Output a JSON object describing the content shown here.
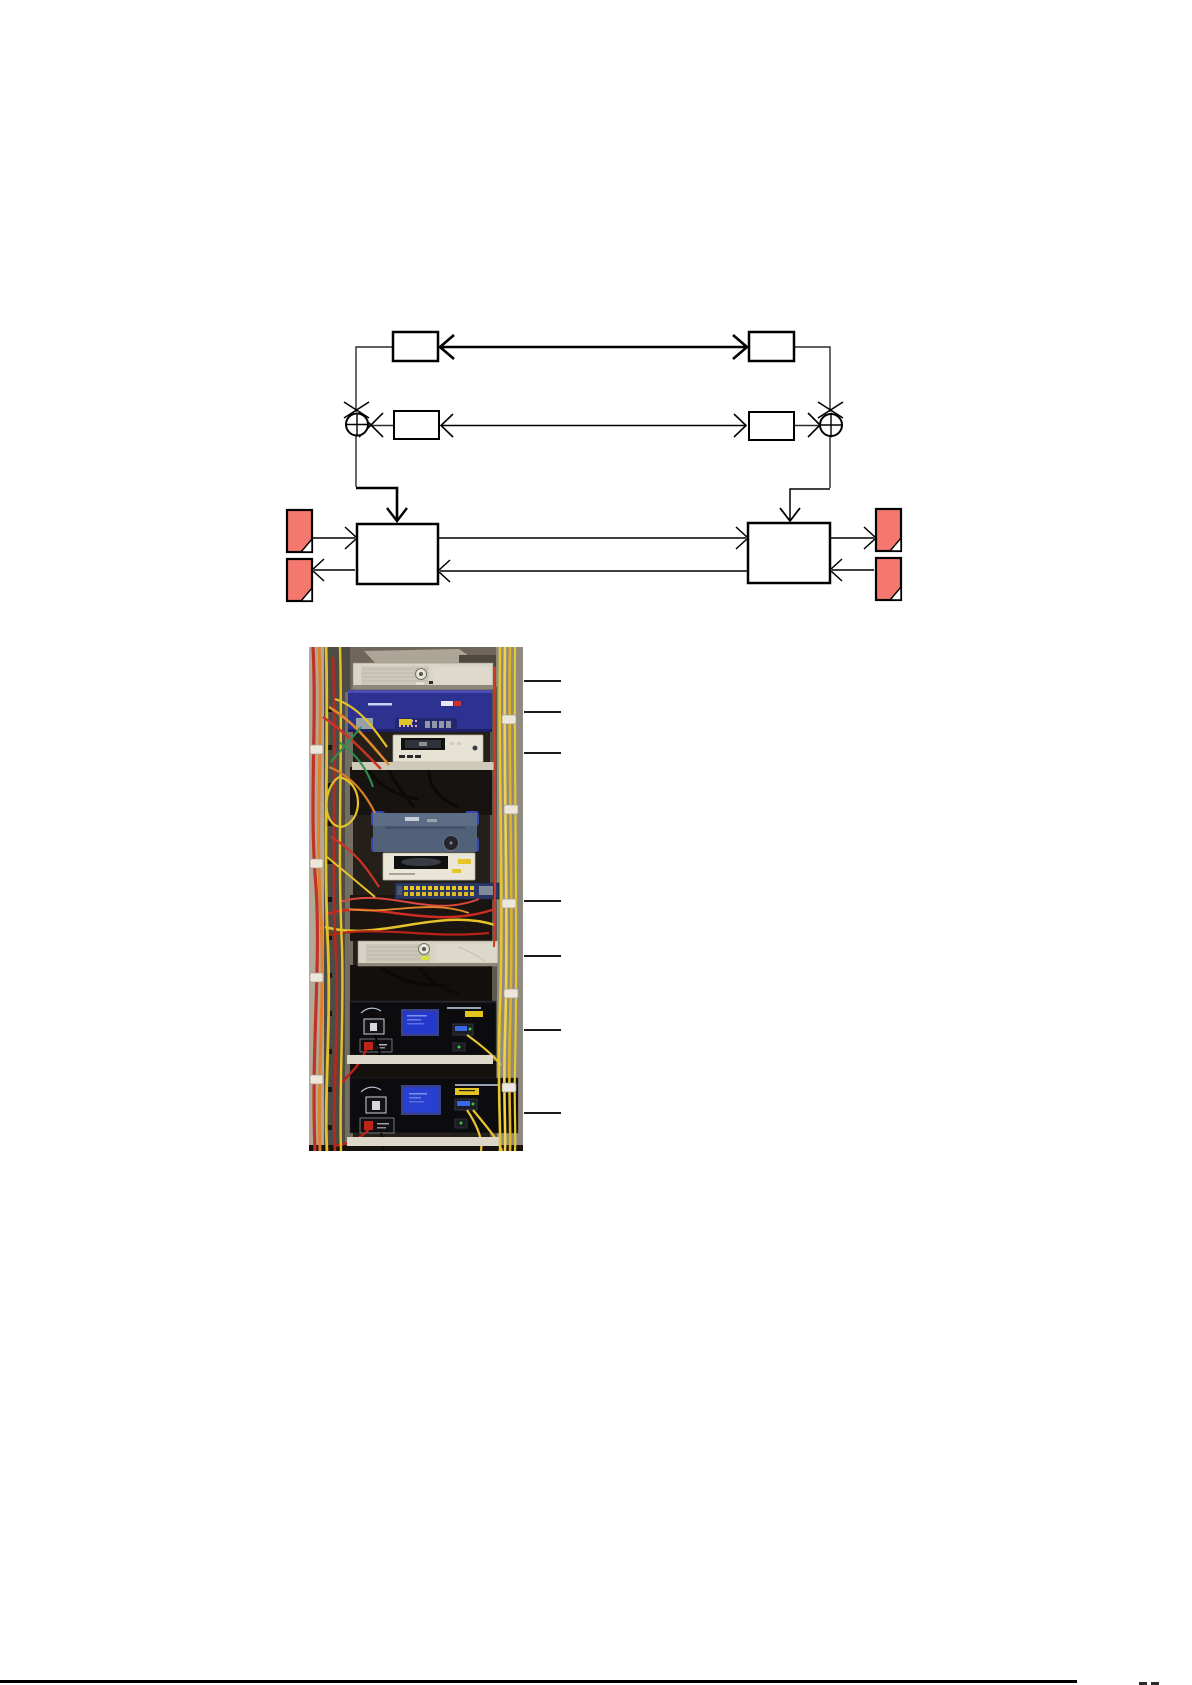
{
  "document": {
    "type": "report-figure-page",
    "visible_text": []
  },
  "colors": {
    "page-bg": "#ffffff",
    "diagram-line": "#000000",
    "doc-red": "#f5786e",
    "callout-color": "#1a1a1a",
    "footer-rule": "#000000"
  },
  "diagram": {
    "alt": "block-diagram-two-terminals-with-adders-and-documents",
    "small_boxes": 4,
    "large_boxes": 2,
    "adder_nodes": 2,
    "document_icons": 4,
    "bidirectional_links": 2
  },
  "photo": {
    "alt": "telecom-equipment-rack-photograph",
    "callout_lines": 7
  }
}
